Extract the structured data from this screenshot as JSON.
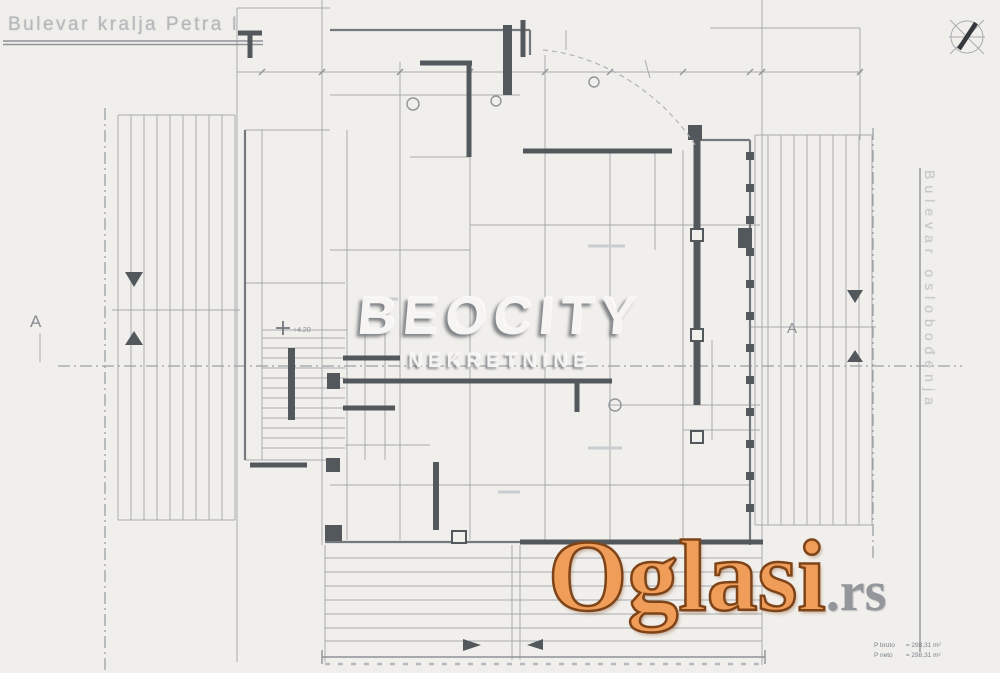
{
  "page": {
    "background": "#f1efeb",
    "line_gray": "#a6abae",
    "wall_dark": "#53585d"
  },
  "streets": {
    "top_label": "Bulevar kralja Petra I",
    "right_label": "Bulevar oslobođenja"
  },
  "section_markers": {
    "left": "A",
    "right": "A"
  },
  "elevation_label": "+4.20",
  "watermarks": {
    "brand": "BEOCITY",
    "brand_sub": "NEKRETNINE",
    "portal": "Oglasi",
    "portal_tld": ".rs",
    "portal_color": "#ef9d58",
    "portal_outline": "#7e4418",
    "tld_color": "#93969a"
  },
  "legend": {
    "rows": [
      {
        "label": "P bruto",
        "value": "= 298,31 m²"
      },
      {
        "label": "P neto",
        "value": "= 298,31 m²"
      }
    ]
  },
  "icons": {
    "compass": "compass-rose"
  }
}
